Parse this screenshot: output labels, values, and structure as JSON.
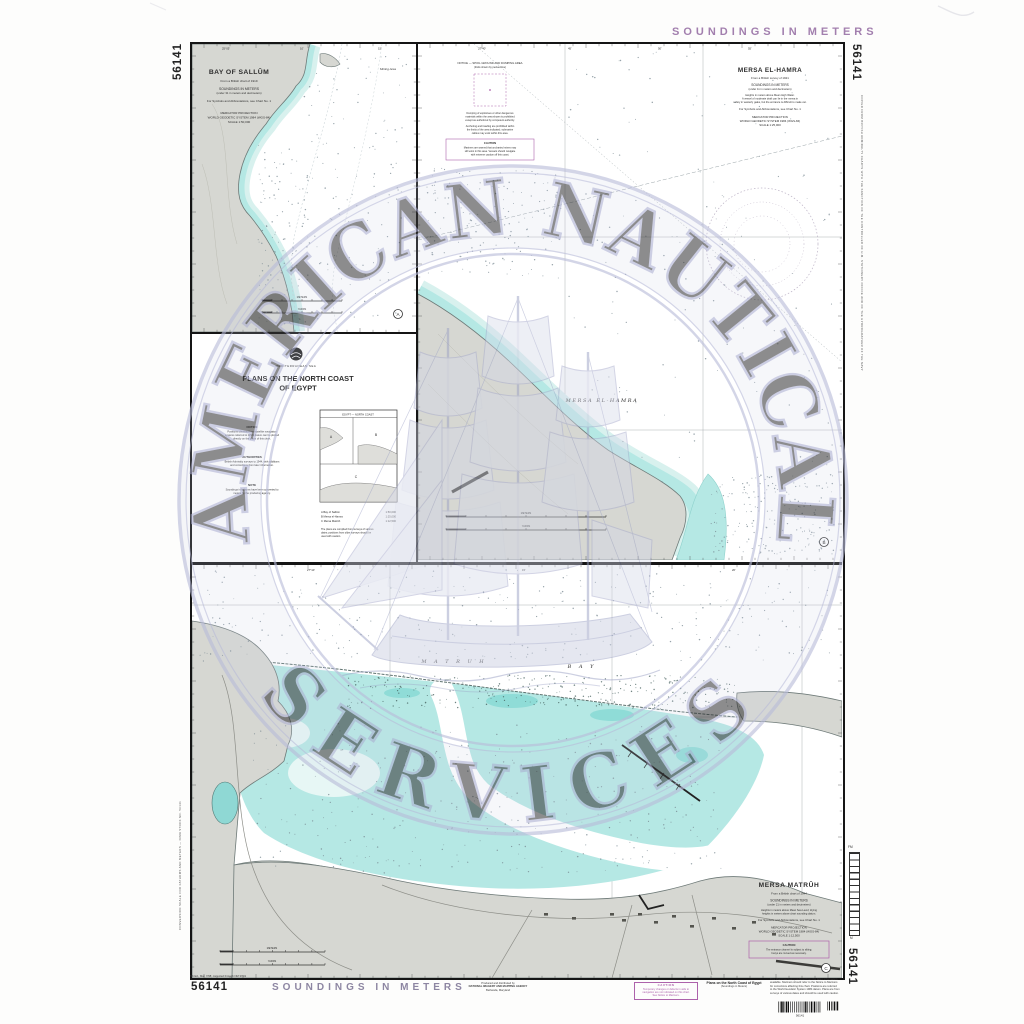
{
  "margins": {
    "chart_number": "56141",
    "soundings_label": "SOUNDINGS IN METERS",
    "left_margin_note": "CONVERSION SCALE FOR FATHOMS AND METERS — NIMA STOCK NO. 56141",
    "right_margin_note": "COPIED FROM BRITISH ADMIRALTY CHARTS WITH THE SANCTION OF THE CONTROLLER OF H.M. STATIONERY OFFICE AND OF THE HYDROGRAPHER OF THE NAVY",
    "ladder_top": "FM",
    "ladder_bottom": "M",
    "edition_note": "5th Ed., Mar. 7/98; corrected through NM 37/01",
    "publisher_lines": [
      "Produced and distributed by",
      "NATIONAL IMAGERY AND MAPPING AGENCY",
      "Bethesda, Maryland"
    ],
    "caution_box": {
      "title": "CAUTION",
      "lines": [
        "Temporary changes or defects in aids to",
        "navigation are not indicated on this chart.",
        "See Notice to Mariners."
      ]
    },
    "footer_title": "Plans on the North Coast of Egypt",
    "footer_subtitle": "(Soundings in Meters)",
    "footer_note_lines": [
      "This chart has been produced from the latest information",
      "available. Mariners should refer to the Notice to Mariners",
      "for corrections affecting this chart. Positions are referred",
      "to the World Geodetic System 1984 datum. Plans are from",
      "surveys of various dates and should be used with caution."
    ],
    "barcode_caption": "56141"
  },
  "watermark": {
    "arc_top": "AMERICAN  NAUTICAL",
    "arc_bottom": "SERVICES"
  },
  "panels": {
    "sallum": {
      "title": "BAY OF SALLÛM",
      "source": "From a British chart of 1919",
      "soundings": "SOUNDINGS IN METERS",
      "soundings_sub": "(under 31 in meters and decimeters)",
      "symbols": "For Symbols and Abbreviations, see Chart No. 1",
      "projection": "MERCATOR PROJECTION",
      "datum": "WORLD GEODETIC SYSTEM 1984 (WGS-84)",
      "scale": "SCALE 1:50,000",
      "area_label": "Mining Area",
      "badge": "A",
      "meters": "METERS",
      "yards": "YARDS",
      "degrees": [
        "25°05'",
        "10'",
        "15'"
      ]
    },
    "hamra": {
      "title": "MERSA EL-HAMRA",
      "source": "From a British survey of 1921",
      "soundings": "SOUNDINGS IN METERS",
      "soundings_sub": "(under 11 in meters and decimeters)",
      "note1": "Heights in meters above Mean High Water.",
      "note2": "A vessel of moderate draft can lie in the mersa in",
      "note3": "safety in westerly gales, but the entrance is difficult to make out.",
      "symbols": "For Symbols and Abbreviations, see Chart No. 1",
      "projection": "MERCATOR PROJECTION",
      "datum": "WORLD GEODETIC SYSTEM 1984 (WGS-84)",
      "scale": "SCALE 1:25,000",
      "map_label": "MERSA EL-HAMRA",
      "badge": "B",
      "meters": "METERS",
      "yards": "YARDS",
      "degrees": [
        "27°40'",
        "45'",
        "50'",
        "55'"
      ],
      "notice": {
        "h1": "NOTICE — SPOIL GROUND AND DUMPING AREA",
        "h2": "(limits shown by pecked line)",
        "p1": [
          "Dumping of explosives or other dangerous",
          "materials within the area shown is prohibited",
          "except as authorized by competent authority."
        ],
        "p2": [
          "Anchoring and trawling are prohibited within",
          "the limits of the area indicated; submarine",
          "cables may exist within this area."
        ],
        "caution_title": "CAUTION",
        "caution_lines": [
          "Mariners are warned that uncharted mines may",
          "still exist in this area. Vessels should navigate",
          "with extreme caution off this coast."
        ]
      }
    },
    "block": {
      "sea": "MEDITERRANEAN SEA",
      "title1": "PLANS ON THE NORTH COAST",
      "title2": "OF EGYPT",
      "sections": [
        {
          "h": "NOTICE",
          "l1": "Positions obtained from satellite navigation",
          "l2": "systems referred to WGS datum can be plotted",
          "l3": "directly on the plans of this chart."
        },
        {
          "h": "AUTHORITIES",
          "l1": "British Admiralty surveys to 1944, with additions",
          "l2": "and corrections from later information.",
          "l3": ""
        },
        {
          "h": "NOTE",
          "l1": "Soundings in fathoms have been converted to",
          "l2": "meters by the producing agency.",
          "l3": ""
        }
      ],
      "index_title": "EGYPT — NORTH COAST",
      "index_a": "A",
      "index_b": "B",
      "index_c": "C",
      "scale_lines": [
        {
          "label": "A  Bay of Sallûm",
          "value": "1:50,000"
        },
        {
          "label": "B  Mersa el-Hamra",
          "value": "1:25,000"
        },
        {
          "label": "C  Mersa Matrûh",
          "value": "1:12,500"
        }
      ],
      "note_lines": [
        "The plans are compiled from surveys of various",
        "dates; positions from older surveys should be",
        "used with caution."
      ]
    },
    "matruh": {
      "title": "MERSA MATRÛH",
      "source": "From a British chart of 1944",
      "soundings": "SOUNDINGS IN METERS",
      "soundings_sub": "(under 21 in meters and decimeters)",
      "note1": "Heights in meters above Mean Sea Level; drying",
      "note2": "heights in meters above chart sounding datum.",
      "symbols": "For Symbols and Abbreviations, see Chart No. 1",
      "projection": "MERCATOR PROJECTION",
      "datum": "WORLD GEODETIC SYSTEM 1984 (WGS-84)",
      "scale": "SCALE 1:12,500",
      "caution": {
        "title": "CAUTION",
        "lines": [
          "The entrance channel is subject to silting;",
          "buoys are moved as necessary."
        ]
      },
      "bay_label_1": "M A T R U H",
      "bay_label_2": "B A Y",
      "badge": "C",
      "meters": "METERS",
      "yards": "YARDS",
      "degrees": [
        "27°10'",
        "15'",
        "20'"
      ]
    }
  }
}
